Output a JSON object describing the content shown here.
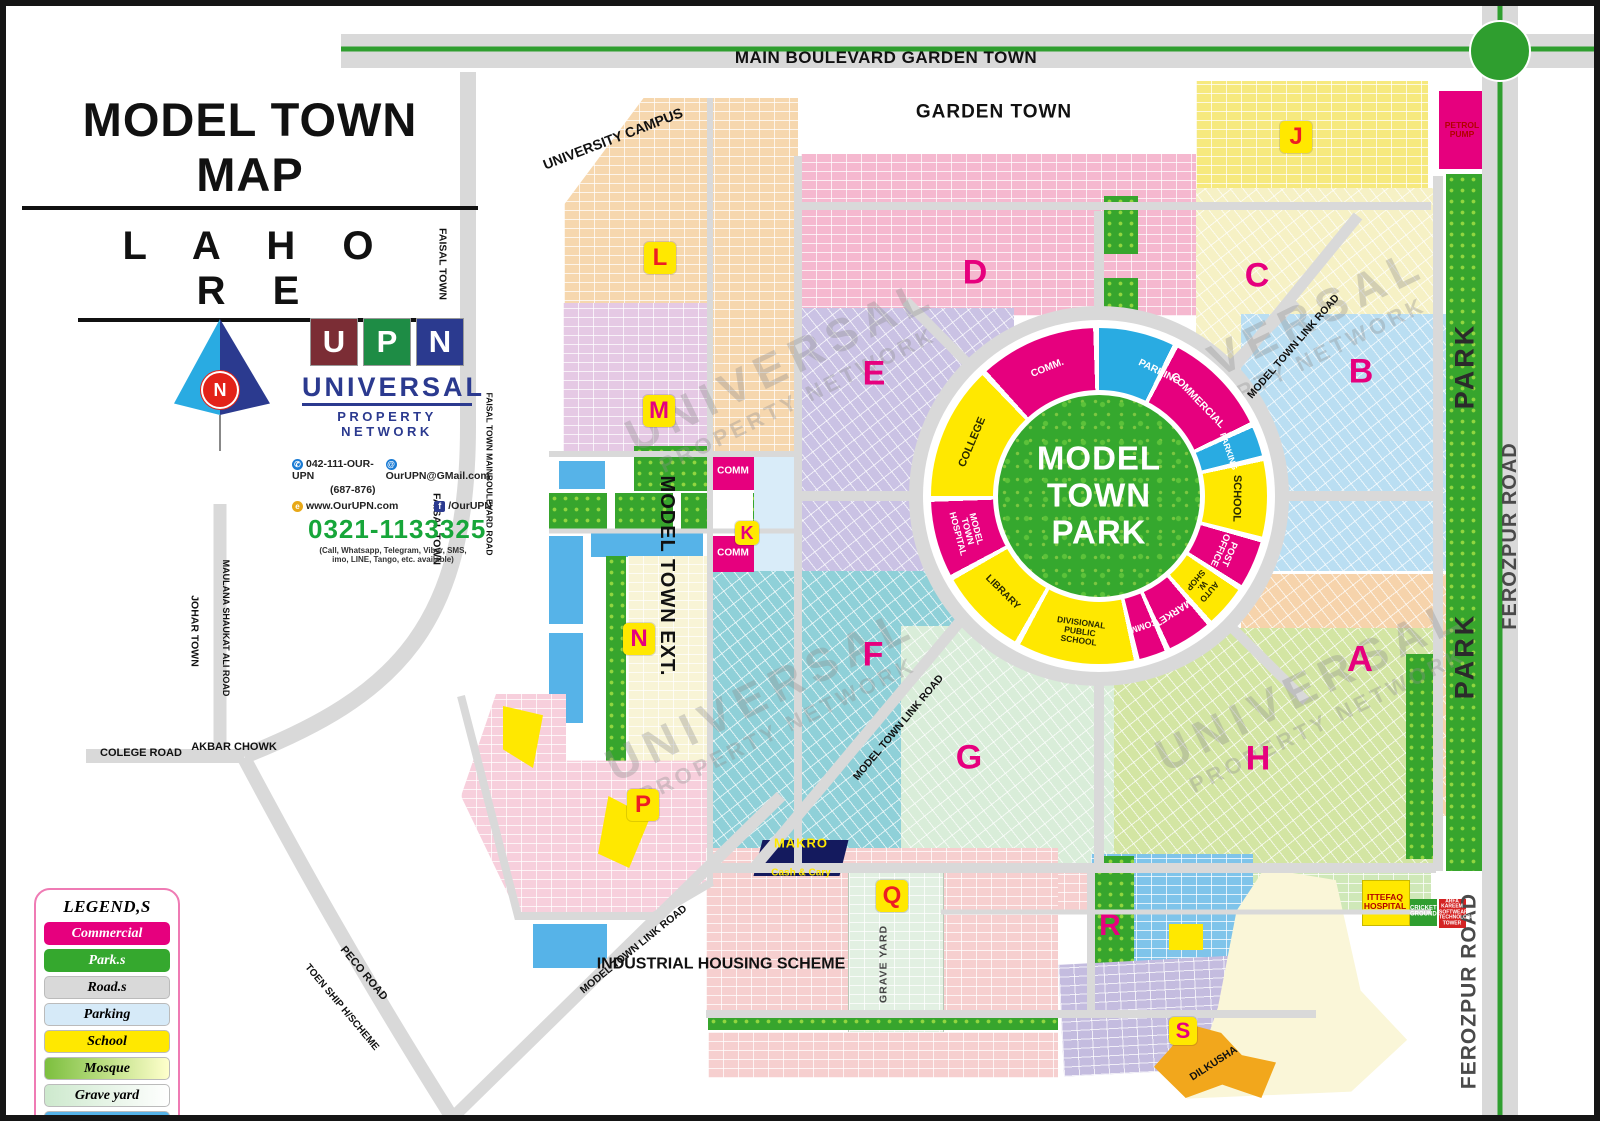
{
  "header": {
    "title": "MODEL TOWN MAP",
    "subtitle": "L A H O R E"
  },
  "branding": {
    "logo_letters": {
      "l0": "U",
      "l1": "P",
      "l2": "N"
    },
    "logo_name": "UNIVERSAL",
    "logo_tagline": "PROPERTY NETWORK",
    "phone_uan": "042-111-OUR-UPN",
    "phone_uan_alt": "(687-876)",
    "email": "OurUPN@GMail.com",
    "website": "www.OurUPN.com",
    "facebook": "/OurUPN",
    "mobile": "0321-1133325",
    "mobile_note": "(Call, Whatsapp, Telegram, Viber, SMS,\nimo, LINE, Tango, etc. available)",
    "north_label": "N",
    "accent_colors": {
      "upn_maroon": "#7b2d35",
      "upn_green": "#1e8c45",
      "upn_blue": "#2b3a8f",
      "phone_green": "#17a63a"
    }
  },
  "legend": {
    "title": "LEGEND,S",
    "items": [
      {
        "label": "Commercial",
        "color": "#e6007e",
        "text_color": "#ffffff"
      },
      {
        "label": "Park.s",
        "color": "#35a82e",
        "text_color": "#ffffff"
      },
      {
        "label": "Road.s",
        "color": "#d9d9d9",
        "text_color": "#000000"
      },
      {
        "label": "Parking",
        "color": "#d6eaf8",
        "text_color": "#000000"
      },
      {
        "label": "School",
        "color": "#ffe800",
        "text_color": "#000000"
      },
      {
        "label": "Mosque",
        "color": "gradient #7cbf3e to #ffffcc",
        "text_color": "#000000"
      },
      {
        "label": "Grave yard",
        "color": "gradient #cde9cd to #ffffff",
        "text_color": "#000000"
      },
      {
        "label": "O.h.t",
        "color": "#56b3e8",
        "text_color": "#000000"
      }
    ]
  },
  "map": {
    "blocks": {
      "A": "A",
      "B": "B",
      "C": "C",
      "D": "D",
      "E": "E",
      "F": "F",
      "G": "G",
      "H": "H",
      "J": "J",
      "K": "K",
      "L": "L",
      "M": "M",
      "N": "N",
      "P": "P",
      "Q": "Q",
      "R": "R",
      "S": "S"
    },
    "ring": {
      "park_name": "MODEL\nTOWN\nPARK",
      "segments": [
        {
          "label": "PARKING",
          "color": "#29abe2"
        },
        {
          "label": "COMMERCIAL",
          "color": "#e6007e"
        },
        {
          "label": "PARKING",
          "color": "#29abe2"
        },
        {
          "label": "SCHOOL",
          "color": "#ffe800"
        },
        {
          "label": "POST OFFICE",
          "color": "#e6007e"
        },
        {
          "label": "AUTO\nW. SHOP",
          "color": "#ffe800"
        },
        {
          "label": "MARKET",
          "color": "#e6007e"
        },
        {
          "label": "COMM.",
          "color": "#e6007e"
        },
        {
          "label": "DIVISIONAL PUBLIC SCHOOL",
          "color": "#ffe800"
        },
        {
          "label": "LIBRARY",
          "color": "#ffe800"
        },
        {
          "label": "MODEL TOWN\nHOSPITAL",
          "color": "#e6007e"
        },
        {
          "label": "COLLEGE",
          "color": "#ffe800"
        },
        {
          "label": "COMM.",
          "color": "#e6007e"
        }
      ]
    },
    "roads": {
      "main_boulevard": "MAIN BOULEVARD GARDEN TOWN",
      "kalma_chowk": "KALMA\nCHOWK",
      "ferozpur": "FEROZPUR ROAD",
      "park_strip": "PARK",
      "link": "MODEL TOWN LINK ROAD",
      "college": "COLEGE ROAD",
      "akbar": "AKBAR CHOWK",
      "peco": "PECO ROAD",
      "toen": "TOEN SHIP H/SCHEME",
      "maulana": "MAULANA SHAUKAT ALI ROAD",
      "faisal_main": "FAISAL TOWN MAINBOULEVARD ROAD"
    },
    "areas": {
      "garden_town": "GARDEN TOWN",
      "university": "UNIVERSITY CAMPUS",
      "johar": "JOHAR TOWN",
      "faisal": "FAISAL TOWN",
      "model_town_ext": "MODEL TOWN EXT.",
      "industrial": "INDUSTRIAL HOUSING SCHEME",
      "grave_yard": "GRAVE YARD",
      "dilkusha": "DILKUSHA"
    },
    "facilities": {
      "petrol": "PETROL\nPUMP",
      "makro_name": "MAKRO",
      "makro_sub": "Cash & Cary",
      "ittefaq": "ITTEFAQ\nHOSPITAL",
      "cricket": "CRICKET GROUND",
      "arfa": "ARFA KAREEM SOFTWEAR TECHNOLOGIES TOWER",
      "comm": "COMM"
    }
  },
  "watermark": {
    "line1": "UNIVERSAL",
    "line2": "PROPERTY NETWORK"
  }
}
